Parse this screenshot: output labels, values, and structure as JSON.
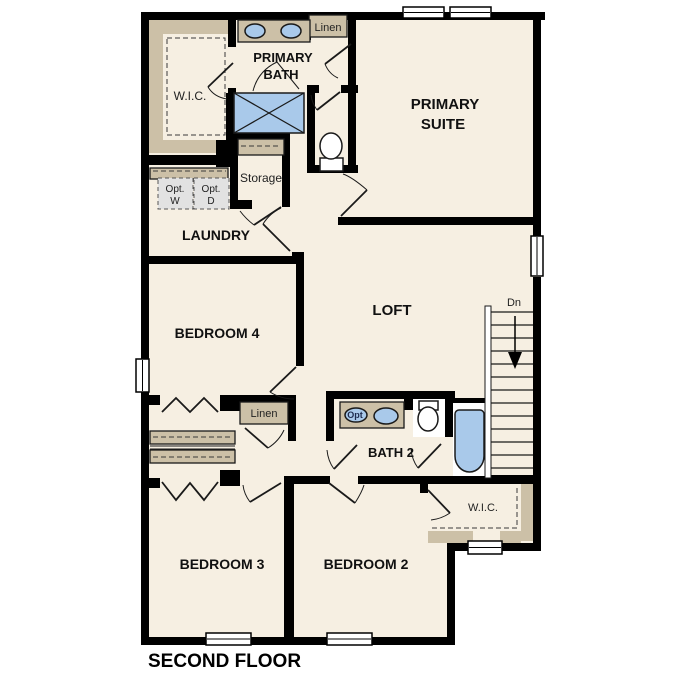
{
  "title": "SECOND FLOOR",
  "colors": {
    "floor": "#f6efe2",
    "wall": "#000000",
    "closet_tan": "#ccc0a7",
    "fixture_blue": "#a9c9ea",
    "appliance_gray": "#e2e2e2"
  },
  "labels": {
    "primary_bath_1": "PRIMARY",
    "primary_bath_2": "BATH",
    "primary_suite_1": "PRIMARY",
    "primary_suite_2": "SUITE",
    "wic_top": "W.I.C.",
    "linen_top": "Linen",
    "storage": "Storage",
    "opt_w_1": "Opt.",
    "opt_w_2": "W",
    "opt_d_1": "Opt.",
    "opt_d_2": "D",
    "laundry": "LAUNDRY",
    "bedroom4": "BEDROOM 4",
    "loft": "LOFT",
    "dn": "Dn",
    "linen_mid": "Linen",
    "bath2": "BATH 2",
    "opt_sink": "Opt",
    "wic_bottom": "W.I.C.",
    "bedroom3": "BEDROOM 3",
    "bedroom2": "BEDROOM 2",
    "floor_title": "SECOND FLOOR"
  }
}
